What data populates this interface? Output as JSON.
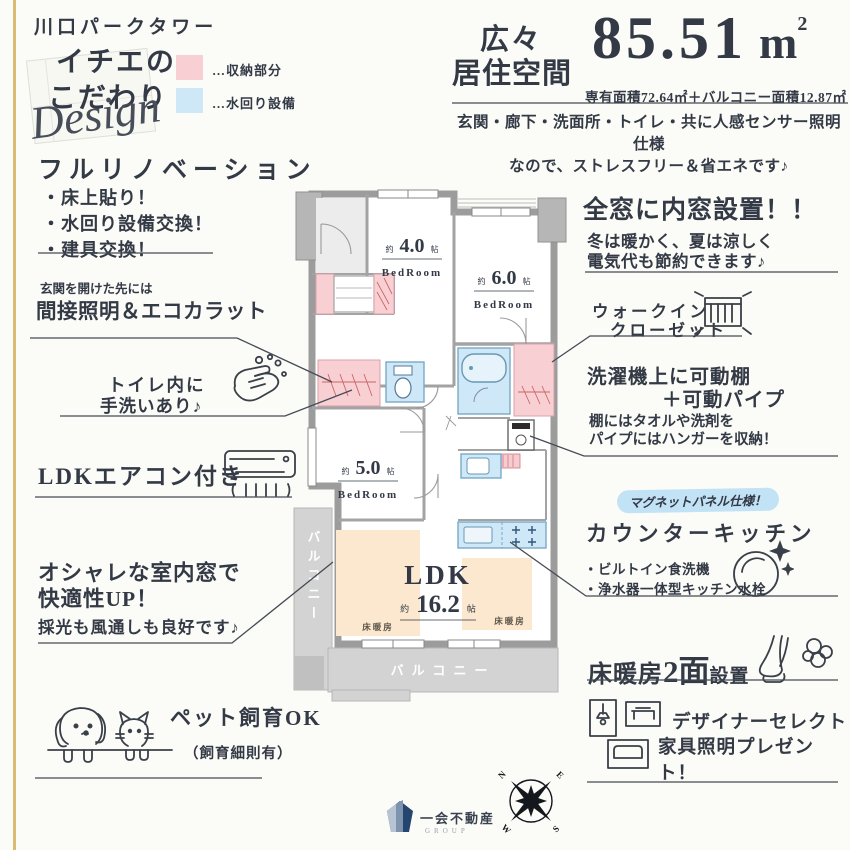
{
  "building_name": "川口パークタワー",
  "brand": {
    "line1": "イチエの",
    "line2": "こだわり",
    "script": "Design"
  },
  "legend": {
    "storage_label": "…収納部分",
    "storage_color": "#f8d0d4",
    "water_label": "…水回り設備",
    "water_color": "#cfe8f8"
  },
  "header": {
    "catch_line1": "広々",
    "catch_line2": "居住空間",
    "area_value": "85.51",
    "area_unit": "m",
    "area_unit_sup": "2",
    "area_breakdown": "専有面積72.64㎡＋バルコニー面積12.87㎡",
    "sensor_line1": "玄関・廊下・洗面所・トイレ・共に人感センサー照明仕様",
    "sensor_line2": "なので、ストレスフリー＆省エネです♪"
  },
  "callouts": {
    "renovation": {
      "title": "フルリノベーション",
      "items": [
        "・床上貼り！",
        "・水回り設備交換！",
        "・建具交換！"
      ]
    },
    "indirect_light": {
      "lead": "玄関を開けた先には",
      "title": "間接照明＆エコカラット"
    },
    "toilet_hand": {
      "line1": "トイレ内に",
      "line2": "手洗いあり♪"
    },
    "aircon": {
      "title": "LDKエアコン付き"
    },
    "interior_window": {
      "line1": "オシャレな室内窓で",
      "line2": "快適性UP！",
      "sub": "採光も風通しも良好です♪"
    },
    "pet": {
      "title": "ペット飼育OK",
      "sub": "（飼育細則有）"
    },
    "inner_window": {
      "title": "全窓に内窓設置！！",
      "sub1": "冬は暖かく、夏は涼しく",
      "sub2": "電気代も節約できます♪"
    },
    "wic": {
      "line1": "ウォークイン",
      "line2": "クローゼット"
    },
    "laundry": {
      "title1": "洗濯機上に可動棚",
      "title2": "＋可動パイプ",
      "sub1": "棚にはタオルや洗剤を",
      "sub2": "パイプにはハンガーを収納！"
    },
    "kitchen": {
      "badge": "マグネットパネル仕様！",
      "title": "カウンターキッチン",
      "items": [
        "・ビルトイン食洗機",
        "・浄水器一体型キッチン水栓"
      ]
    },
    "floor_heating": {
      "part1": "床暖房",
      "part2": "2面",
      "part3": "設置"
    },
    "designer": {
      "line1": "デザイナーセレクト",
      "line2": "家具照明プレゼント！"
    }
  },
  "floor_plan": {
    "bedroom4": {
      "prefix": "約",
      "size": "4.0",
      "unit": "帖",
      "type": "BedRoom"
    },
    "bedroom6": {
      "prefix": "約",
      "size": "6.0",
      "unit": "帖",
      "type": "BedRoom"
    },
    "bedroom5": {
      "prefix": "約",
      "size": "5.0",
      "unit": "帖",
      "type": "BedRoom"
    },
    "ldk": {
      "title": "LDK",
      "prefix": "約",
      "size": "16.2",
      "unit": "帖"
    },
    "balcony_bottom": "バルコニー",
    "balcony_left": "バルコニー",
    "floor_heating_label1": "床暖房",
    "floor_heating_label2": "床暖房",
    "colors": {
      "storage": "#f8d0d4",
      "water": "#cfe8f8",
      "heating": "#fbe8cf",
      "balcony": "#d3d3d3",
      "wall": "#9c9c9c",
      "accent_gold": "#d9bc72"
    }
  },
  "compass": {
    "n": "N",
    "e": "E",
    "s": "S",
    "w": "W"
  },
  "footer": {
    "company": "一会不動産",
    "group": "GROUP"
  }
}
